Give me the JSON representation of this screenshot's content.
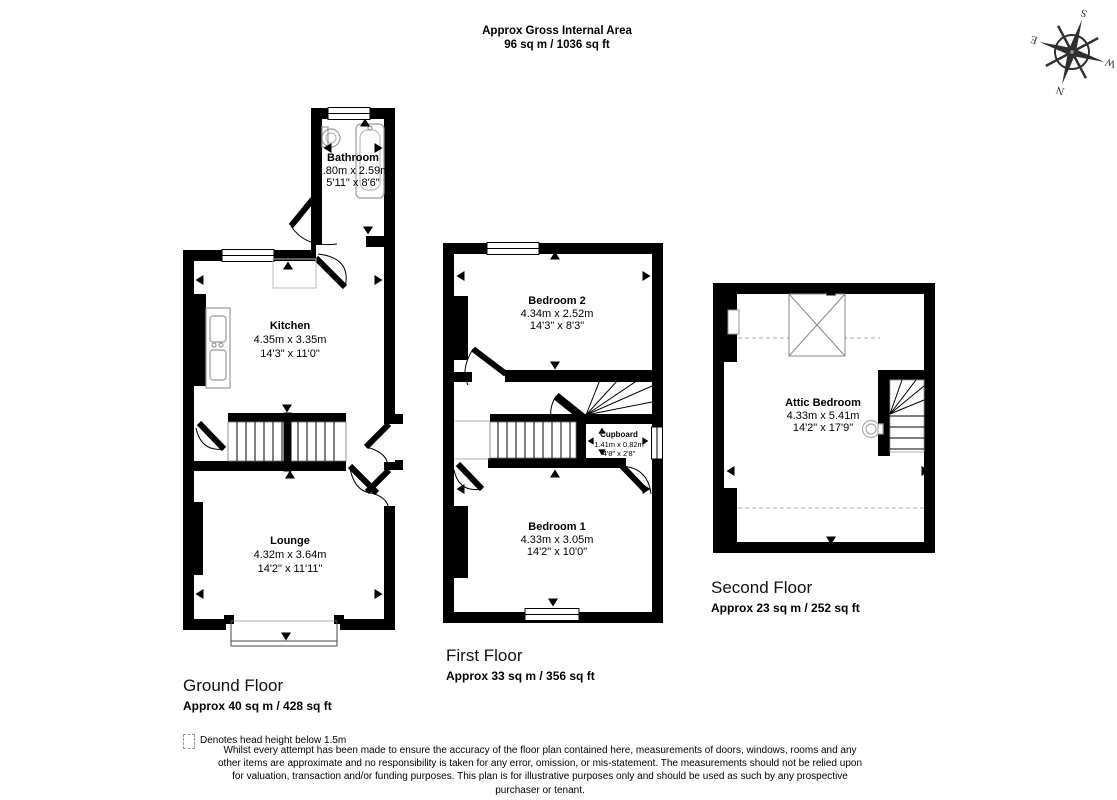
{
  "header": {
    "title": "Approx Gross Internal Area",
    "area": "96 sq m / 1036 sq ft"
  },
  "compass": {
    "n": "N",
    "s": "S",
    "e": "E",
    "w": "W"
  },
  "floors": [
    {
      "label": "Ground Floor",
      "area": "Approx 40 sq m / 428 sq ft",
      "rooms": [
        {
          "name": "Bathroom",
          "metric": "1.80m x 2.59m",
          "imperial": "5'11\" x 8'6\""
        },
        {
          "name": "Kitchen",
          "metric": "4.35m x 3.35m",
          "imperial": "14'3\" x 11'0\""
        },
        {
          "name": "Lounge",
          "metric": "4.32m x 3.64m",
          "imperial": "14'2\" x 11'11\""
        }
      ]
    },
    {
      "label": "First Floor",
      "area": "Approx 33 sq m / 356 sq ft",
      "rooms": [
        {
          "name": "Bedroom 2",
          "metric": "4.34m x 2.52m",
          "imperial": "14'3\" x 8'3\""
        },
        {
          "name": "Cupboard",
          "metric": "1.41m x 0.82m",
          "imperial": "4'8\" x 2'8\""
        },
        {
          "name": "Bedroom 1",
          "metric": "4.33m x 3.05m",
          "imperial": "14'2\" x 10'0\""
        }
      ]
    },
    {
      "label": "Second Floor",
      "area": "Approx 23 sq m / 252 sq ft",
      "rooms": [
        {
          "name": "Attic Bedroom",
          "metric": "4.33m x 5.41m",
          "imperial": "14'2\" x 17'9\""
        }
      ]
    }
  ],
  "legend": {
    "text": "Denotes head height below 1.5m"
  },
  "disclaimer": "Whilst every attempt has been made to ensure the accuracy of the floor plan contained here, measurements of doors, windows, rooms and any other items are approximate and no responsibility is taken for any error, omission, or mis-statement. The measurements should not be relied upon for valuation, transaction and/or funding purposes. This plan is for illustrative purposes only and should be used as such by any prospective purchaser or tenant.",
  "colors": {
    "walls": "#000000",
    "fixtures": "#999999",
    "dashes": "#aaaaaa"
  }
}
